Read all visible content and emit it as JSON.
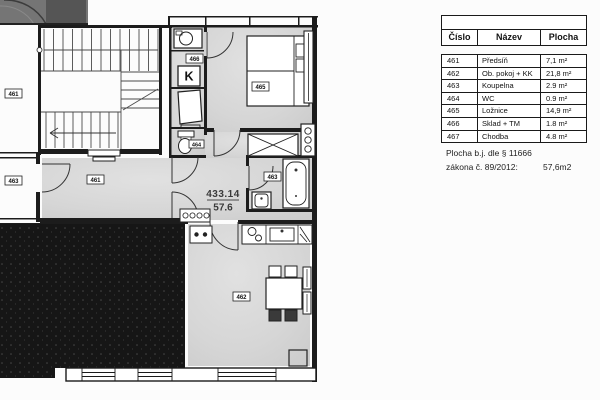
{
  "plan": {
    "unit_number": "433.14",
    "unit_area": "57.6",
    "labels": {
      "neighbor_upper": "461",
      "neighbor_lower": "463",
      "predsin": "461",
      "sklad": "466",
      "boiler": "K",
      "wc": "464",
      "bedroom": "465",
      "bathroom": "463",
      "living": "462"
    }
  },
  "table": {
    "headers": {
      "cislo": "Číslo",
      "nazev": "Název",
      "plocha": "Plocha"
    },
    "rows": [
      {
        "cislo": "461",
        "nazev": "Předsíň",
        "plocha": "7,1 m²"
      },
      {
        "cislo": "462",
        "nazev": "Ob. pokoj + KK",
        "plocha": "21,8 m²"
      },
      {
        "cislo": "463",
        "nazev": "Koupelna",
        "plocha": "2.9 m²"
      },
      {
        "cislo": "464",
        "nazev": "WC",
        "plocha": "0.9 m²"
      },
      {
        "cislo": "465",
        "nazev": "Ložnice",
        "plocha": "14,9 m²"
      },
      {
        "cislo": "466",
        "nazev": "Sklad + TM",
        "plocha": "1.8 m²"
      },
      {
        "cislo": "467",
        "nazev": "Chodba",
        "plocha": "4.8 m²"
      }
    ]
  },
  "note": {
    "line1": "Plocha b.j. dle § 11666",
    "line2_label": "zákona č. 89/2012:",
    "line2_value": "57,6m2"
  },
  "colors": {
    "wall": "#1c1c1c",
    "room_fill": "#d6d6d6",
    "masked_unit": "#161616",
    "paper": "#fcfcfc"
  }
}
